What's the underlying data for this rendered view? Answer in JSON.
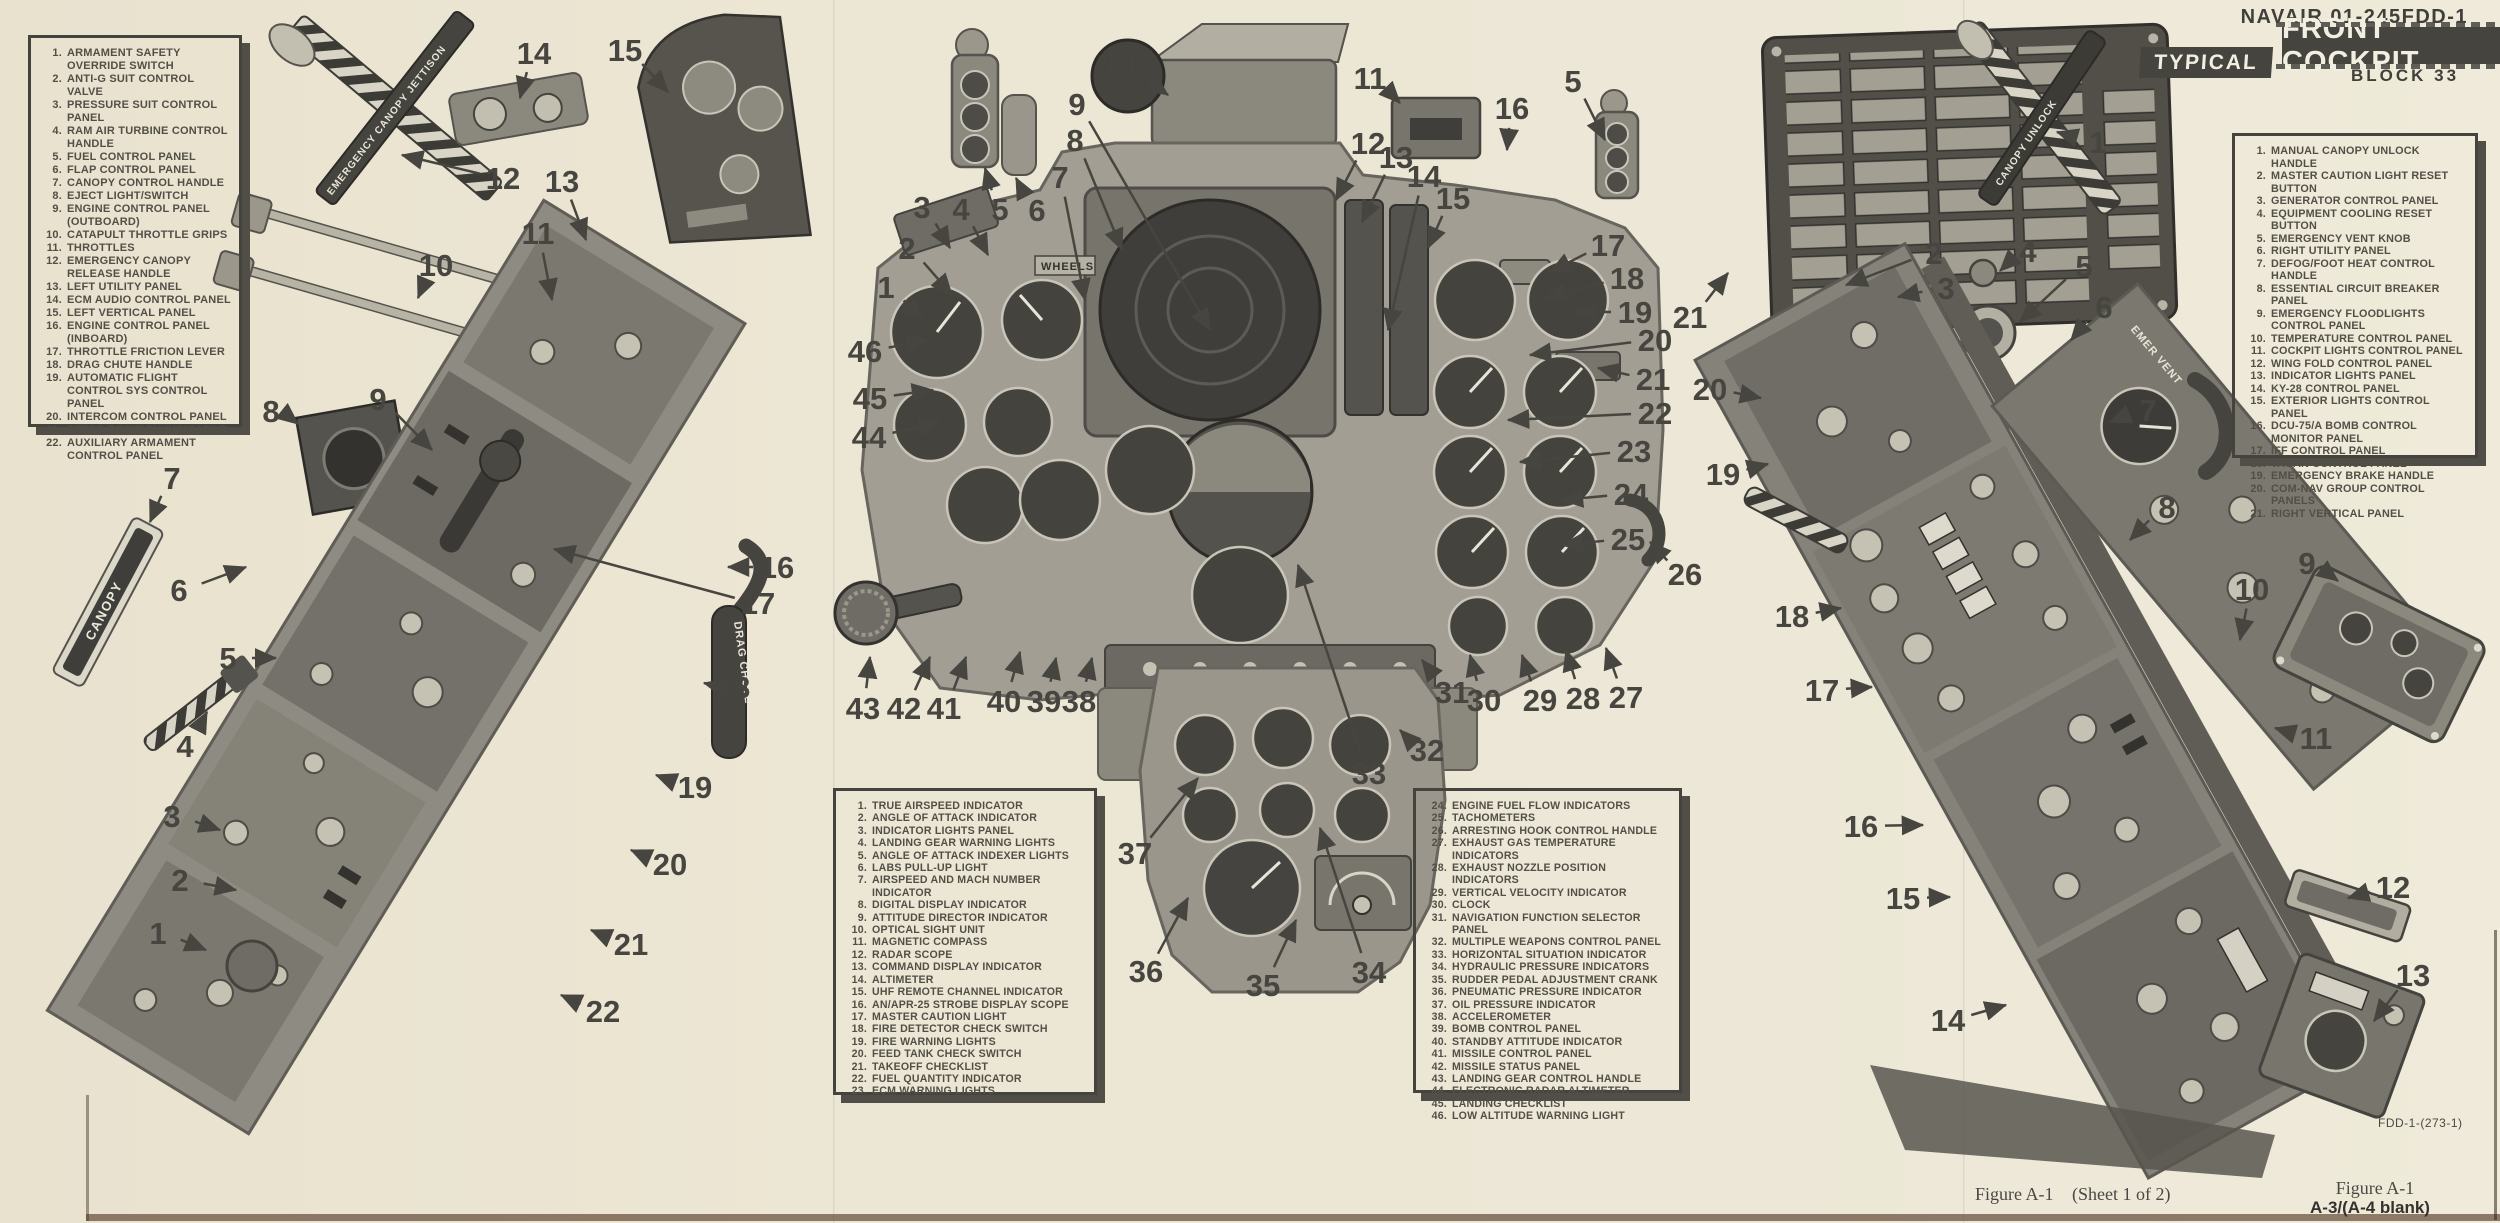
{
  "page": {
    "doc_number": "NAVAIR 01-245FDD-1",
    "title": "FRONT COCKPIT",
    "title_tag": "TYPICAL",
    "subtitle": "BLOCK 33",
    "caption_figure": "Figure A-1",
    "caption_sheet": "(Sheet 1 of 2)",
    "figure_ref": "Figure A-1",
    "page_number": "A-3/(A-4 blank)",
    "plate_code": "FDD-1-(273-1)"
  },
  "labels": {
    "canopy": "CANOPY",
    "drag_chute": "DRAG CHUTE",
    "jettison": "EMERGENCY CANOPY JETTISON",
    "unlock": "CANOPY UNLOCK",
    "emer_vent": "EMER VENT",
    "wheels": "WHEELS",
    "fire_l": "FIRE",
    "fire_r": "FIRE"
  },
  "legends": {
    "left_console": {
      "items": [
        {
          "n": "1.",
          "t": "ARMAMENT SAFETY OVERRIDE SWITCH"
        },
        {
          "n": "2.",
          "t": "ANTI-G SUIT CONTROL VALVE"
        },
        {
          "n": "3.",
          "t": "PRESSURE SUIT CONTROL PANEL"
        },
        {
          "n": "4.",
          "t": "RAM AIR TURBINE CONTROL HANDLE"
        },
        {
          "n": "5.",
          "t": "FUEL CONTROL PANEL"
        },
        {
          "n": "6.",
          "t": "FLAP CONTROL PANEL"
        },
        {
          "n": "7.",
          "t": "CANOPY CONTROL HANDLE"
        },
        {
          "n": "8.",
          "t": "EJECT LIGHT/SWITCH"
        },
        {
          "n": "9.",
          "t": "ENGINE CONTROL PANEL (OUTBOARD)"
        },
        {
          "n": "10.",
          "t": "CATAPULT THROTTLE GRIPS"
        },
        {
          "n": "11.",
          "t": "THROTTLES"
        },
        {
          "n": "12.",
          "t": "EMERGENCY CANOPY RELEASE HANDLE"
        },
        {
          "n": "13.",
          "t": "LEFT UTILITY PANEL"
        },
        {
          "n": "14.",
          "t": "ECM AUDIO CONTROL PANEL"
        },
        {
          "n": "15.",
          "t": "LEFT VERTICAL PANEL"
        },
        {
          "n": "16.",
          "t": "ENGINE CONTROL PANEL (INBOARD)"
        },
        {
          "n": "17.",
          "t": "THROTTLE FRICTION LEVER"
        },
        {
          "n": "18.",
          "t": "DRAG CHUTE HANDLE"
        },
        {
          "n": "19.",
          "t": "AUTOMATIC FLIGHT CONTROL SYS CONTROL PANEL"
        },
        {
          "n": "20.",
          "t": "INTERCOM CONTROL PANEL"
        },
        {
          "n": "21.",
          "t": "STEPS POSITION INDICATOR"
        },
        {
          "n": "22.",
          "t": "AUXILIARY ARMAMENT CONTROL PANEL"
        }
      ]
    },
    "main_panel_a": {
      "items": [
        {
          "n": "1.",
          "t": "TRUE AIRSPEED INDICATOR"
        },
        {
          "n": "2.",
          "t": "ANGLE OF ATTACK INDICATOR"
        },
        {
          "n": "3.",
          "t": "INDICATOR LIGHTS PANEL"
        },
        {
          "n": "4.",
          "t": "LANDING GEAR WARNING LIGHTS"
        },
        {
          "n": "5.",
          "t": "ANGLE OF ATTACK INDEXER LIGHTS"
        },
        {
          "n": "6.",
          "t": "LABS PULL-UP LIGHT"
        },
        {
          "n": "7.",
          "t": "AIRSPEED AND MACH NUMBER INDICATOR"
        },
        {
          "n": "8.",
          "t": "DIGITAL DISPLAY INDICATOR"
        },
        {
          "n": "9.",
          "t": "ATTITUDE DIRECTOR INDICATOR"
        },
        {
          "n": "10.",
          "t": "OPTICAL SIGHT UNIT"
        },
        {
          "n": "11.",
          "t": "MAGNETIC COMPASS"
        },
        {
          "n": "12.",
          "t": "RADAR SCOPE"
        },
        {
          "n": "13.",
          "t": "COMMAND DISPLAY INDICATOR"
        },
        {
          "n": "14.",
          "t": "ALTIMETER"
        },
        {
          "n": "15.",
          "t": "UHF REMOTE CHANNEL INDICATOR"
        },
        {
          "n": "16.",
          "t": "AN/APR-25 STROBE DISPLAY SCOPE"
        },
        {
          "n": "17.",
          "t": "MASTER CAUTION LIGHT"
        },
        {
          "n": "18.",
          "t": "FIRE DETECTOR CHECK SWITCH"
        },
        {
          "n": "19.",
          "t": "FIRE WARNING LIGHTS"
        },
        {
          "n": "20.",
          "t": "FEED TANK CHECK SWITCH"
        },
        {
          "n": "21.",
          "t": "TAKEOFF CHECKLIST"
        },
        {
          "n": "22.",
          "t": "FUEL QUANTITY INDICATOR"
        },
        {
          "n": "23.",
          "t": "ECM WARNING LIGHTS"
        }
      ]
    },
    "main_panel_b": {
      "items": [
        {
          "n": "24.",
          "t": "ENGINE FUEL FLOW INDICATORS"
        },
        {
          "n": "25.",
          "t": "TACHOMETERS"
        },
        {
          "n": "26.",
          "t": "ARRESTING HOOK CONTROL HANDLE"
        },
        {
          "n": "27.",
          "t": "EXHAUST GAS TEMPERATURE INDICATORS"
        },
        {
          "n": "28.",
          "t": "EXHAUST NOZZLE POSITION INDICATORS"
        },
        {
          "n": "29.",
          "t": "VERTICAL VELOCITY INDICATOR"
        },
        {
          "n": "30.",
          "t": "CLOCK"
        },
        {
          "n": "31.",
          "t": "NAVIGATION FUNCTION SELECTOR PANEL"
        },
        {
          "n": "32.",
          "t": "MULTIPLE WEAPONS CONTROL PANEL"
        },
        {
          "n": "33.",
          "t": "HORIZONTAL SITUATION INDICATOR"
        },
        {
          "n": "34.",
          "t": "HYDRAULIC PRESSURE INDICATORS"
        },
        {
          "n": "35.",
          "t": "RUDDER PEDAL ADJUSTMENT CRANK"
        },
        {
          "n": "36.",
          "t": "PNEUMATIC PRESSURE INDICATOR"
        },
        {
          "n": "37.",
          "t": "OIL PRESSURE INDICATOR"
        },
        {
          "n": "38.",
          "t": "ACCELEROMETER"
        },
        {
          "n": "39.",
          "t": "BOMB CONTROL PANEL"
        },
        {
          "n": "40.",
          "t": "STANDBY ATTITUDE INDICATOR"
        },
        {
          "n": "41.",
          "t": "MISSILE CONTROL PANEL"
        },
        {
          "n": "42.",
          "t": "MISSILE STATUS PANEL"
        },
        {
          "n": "43.",
          "t": "LANDING GEAR CONTROL HANDLE"
        },
        {
          "n": "44.",
          "t": "ELECTRONIC RADAR ALTIMETER"
        },
        {
          "n": "45.",
          "t": "LANDING CHECKLIST"
        },
        {
          "n": "46.",
          "t": "LOW ALTITUDE WARNING LIGHT"
        }
      ]
    },
    "right_console": {
      "items": [
        {
          "n": "1.",
          "t": "MANUAL CANOPY UNLOCK HANDLE"
        },
        {
          "n": "2.",
          "t": "MASTER CAUTION LIGHT RESET BUTTON"
        },
        {
          "n": "3.",
          "t": "GENERATOR CONTROL PANEL"
        },
        {
          "n": "4.",
          "t": "EQUIPMENT COOLING RESET BUTTON"
        },
        {
          "n": "5.",
          "t": "EMERGENCY VENT KNOB"
        },
        {
          "n": "6.",
          "t": "RIGHT UTILITY PANEL"
        },
        {
          "n": "7.",
          "t": "DEFOG/FOOT HEAT CONTROL HANDLE"
        },
        {
          "n": "8.",
          "t": "ESSENTIAL CIRCUIT BREAKER PANEL"
        },
        {
          "n": "9.",
          "t": "EMERGENCY FLOODLIGHTS CONTROL PANEL"
        },
        {
          "n": "10.",
          "t": "TEMPERATURE CONTROL PANEL"
        },
        {
          "n": "11.",
          "t": "COCKPIT LIGHTS CONTROL PANEL"
        },
        {
          "n": "12.",
          "t": "WING FOLD CONTROL PANEL"
        },
        {
          "n": "13.",
          "t": "INDICATOR LIGHTS PANEL"
        },
        {
          "n": "14.",
          "t": "KY-28 CONTROL PANEL"
        },
        {
          "n": "15.",
          "t": "EXTERIOR LIGHTS CONTROL PANEL"
        },
        {
          "n": "16.",
          "t": "DCU-75/A BOMB CONTROL MONITOR PANEL"
        },
        {
          "n": "17.",
          "t": "IFF CONTROL PANEL"
        },
        {
          "n": "18.",
          "t": "TACAN CONTROL PANEL"
        },
        {
          "n": "19.",
          "t": "EMERGENCY BRAKE HANDLE"
        },
        {
          "n": "20.",
          "t": "COM-NAV GROUP CONTROL PANELS"
        },
        {
          "n": "21.",
          "t": "RIGHT VERTICAL PANEL"
        }
      ]
    }
  },
  "callouts": {
    "left": [
      {
        "n": "14",
        "x": 534,
        "y": 53,
        "tx": 520,
        "ty": 98
      },
      {
        "n": "15",
        "x": 625,
        "y": 50,
        "tx": 668,
        "ty": 92
      },
      {
        "n": "12",
        "x": 503,
        "y": 178,
        "tx": 402,
        "ty": 155
      },
      {
        "n": "13",
        "x": 562,
        "y": 181,
        "tx": 586,
        "ty": 240
      },
      {
        "n": "11",
        "x": 538,
        "y": 233,
        "tx": 552,
        "ty": 300
      },
      {
        "n": "10",
        "x": 436,
        "y": 265,
        "tx": 418,
        "ty": 298
      },
      {
        "n": "9",
        "x": 378,
        "y": 399,
        "tx": 432,
        "ty": 450
      },
      {
        "n": "8",
        "x": 271,
        "y": 411,
        "tx": 298,
        "ty": 424
      },
      {
        "n": "7",
        "x": 172,
        "y": 478,
        "tx": 150,
        "ty": 522
      },
      {
        "n": "6",
        "x": 179,
        "y": 590,
        "tx": 246,
        "ty": 567
      },
      {
        "n": "5",
        "x": 228,
        "y": 658,
        "tx": 276,
        "ty": 658
      },
      {
        "n": "4",
        "x": 185,
        "y": 746,
        "tx": 207,
        "ty": 712
      },
      {
        "n": "3",
        "x": 172,
        "y": 816,
        "tx": 220,
        "ty": 830
      },
      {
        "n": "2",
        "x": 180,
        "y": 880,
        "tx": 236,
        "ty": 890
      },
      {
        "n": "1",
        "x": 158,
        "y": 933,
        "tx": 206,
        "ty": 950
      },
      {
        "n": "16",
        "x": 777,
        "y": 567,
        "tx": 728,
        "ty": 567
      },
      {
        "n": "17",
        "x": 758,
        "y": 603,
        "tx": 554,
        "ty": 549
      },
      {
        "n": "18",
        "x": 733,
        "y": 687,
        "tx": 704,
        "ty": 683
      },
      {
        "n": "19",
        "x": 695,
        "y": 787,
        "tx": 656,
        "ty": 775
      },
      {
        "n": "20",
        "x": 670,
        "y": 864,
        "tx": 631,
        "ty": 850
      },
      {
        "n": "21",
        "x": 631,
        "y": 944,
        "tx": 591,
        "ty": 930
      },
      {
        "n": "22",
        "x": 603,
        "y": 1011,
        "tx": 561,
        "ty": 995
      }
    ],
    "center": [
      {
        "n": "10",
        "x": 1119,
        "y": 63,
        "tx": 1168,
        "ty": 95
      },
      {
        "n": "9",
        "x": 1077,
        "y": 104,
        "tx": 1210,
        "ty": 330
      },
      {
        "n": "8",
        "x": 1075,
        "y": 140,
        "tx": 1122,
        "ty": 250
      },
      {
        "n": "7",
        "x": 1060,
        "y": 177,
        "tx": 1085,
        "ty": 300
      },
      {
        "n": "3",
        "x": 922,
        "y": 207,
        "tx": 950,
        "ty": 248
      },
      {
        "n": "4",
        "x": 961,
        "y": 209,
        "tx": 988,
        "ty": 255
      },
      {
        "n": "5",
        "x": 1000,
        "y": 209,
        "tx": 985,
        "ty": 168
      },
      {
        "n": "6",
        "x": 1037,
        "y": 210,
        "tx": 1016,
        "ty": 178
      },
      {
        "n": "2",
        "x": 907,
        "y": 248,
        "tx": 952,
        "ty": 295
      },
      {
        "n": "1",
        "x": 886,
        "y": 287,
        "tx": 922,
        "ty": 320
      },
      {
        "n": "46",
        "x": 865,
        "y": 351,
        "tx": 928,
        "ty": 340
      },
      {
        "n": "45",
        "x": 870,
        "y": 398,
        "tx": 933,
        "ty": 390
      },
      {
        "n": "44",
        "x": 869,
        "y": 437,
        "tx": 940,
        "ty": 422
      },
      {
        "n": "11",
        "x": 1370,
        "y": 78,
        "tx": 1400,
        "ty": 103
      },
      {
        "n": "5",
        "x": 1573,
        "y": 81,
        "tx": 1605,
        "ty": 140
      },
      {
        "n": "16",
        "x": 1512,
        "y": 108,
        "tx": 1507,
        "ty": 150
      },
      {
        "n": "12",
        "x": 1368,
        "y": 143,
        "tx": 1336,
        "ty": 200
      },
      {
        "n": "13",
        "x": 1396,
        "y": 157,
        "tx": 1362,
        "ty": 222
      },
      {
        "n": "14",
        "x": 1424,
        "y": 176,
        "tx": 1388,
        "ty": 330
      },
      {
        "n": "15",
        "x": 1453,
        "y": 198,
        "tx": 1428,
        "ty": 248
      },
      {
        "n": "17",
        "x": 1608,
        "y": 245,
        "tx": 1550,
        "ty": 272
      },
      {
        "n": "18",
        "x": 1627,
        "y": 278,
        "tx": 1545,
        "ty": 298
      },
      {
        "n": "19",
        "x": 1635,
        "y": 312,
        "tx": 1576,
        "ty": 312
      },
      {
        "n": "20",
        "x": 1655,
        "y": 340,
        "tx": 1530,
        "ty": 355
      },
      {
        "n": "21",
        "x": 1653,
        "y": 379,
        "tx": 1598,
        "ty": 368
      },
      {
        "n": "22",
        "x": 1655,
        "y": 413,
        "tx": 1508,
        "ty": 420
      },
      {
        "n": "23",
        "x": 1634,
        "y": 451,
        "tx": 1520,
        "ty": 462
      },
      {
        "n": "24",
        "x": 1631,
        "y": 494,
        "tx": 1562,
        "ty": 500
      },
      {
        "n": "25",
        "x": 1628,
        "y": 539,
        "tx": 1562,
        "ty": 545
      },
      {
        "n": "26",
        "x": 1685,
        "y": 574,
        "tx": 1650,
        "ty": 542
      },
      {
        "n": "27",
        "x": 1626,
        "y": 697,
        "tx": 1606,
        "ty": 648
      },
      {
        "n": "28",
        "x": 1583,
        "y": 698,
        "tx": 1566,
        "ty": 650
      },
      {
        "n": "29",
        "x": 1540,
        "y": 700,
        "tx": 1522,
        "ty": 655
      },
      {
        "n": "30",
        "x": 1484,
        "y": 700,
        "tx": 1470,
        "ty": 655
      },
      {
        "n": "31",
        "x": 1452,
        "y": 692,
        "tx": 1422,
        "ty": 660
      },
      {
        "n": "32",
        "x": 1427,
        "y": 750,
        "tx": 1400,
        "ty": 730
      },
      {
        "n": "33",
        "x": 1369,
        "y": 773,
        "tx": 1298,
        "ty": 565
      },
      {
        "n": "34",
        "x": 1369,
        "y": 972,
        "tx": 1320,
        "ty": 828
      },
      {
        "n": "35",
        "x": 1263,
        "y": 985,
        "tx": 1296,
        "ty": 920
      },
      {
        "n": "36",
        "x": 1146,
        "y": 971,
        "tx": 1188,
        "ty": 898
      },
      {
        "n": "37",
        "x": 1135,
        "y": 853,
        "tx": 1198,
        "ty": 778
      },
      {
        "n": "38",
        "x": 1079,
        "y": 701,
        "tx": 1092,
        "ty": 658
      },
      {
        "n": "39",
        "x": 1044,
        "y": 701,
        "tx": 1056,
        "ty": 658
      },
      {
        "n": "40",
        "x": 1004,
        "y": 701,
        "tx": 1020,
        "ty": 652
      },
      {
        "n": "41",
        "x": 944,
        "y": 708,
        "tx": 966,
        "ty": 657
      },
      {
        "n": "42",
        "x": 904,
        "y": 708,
        "tx": 930,
        "ty": 657
      },
      {
        "n": "43",
        "x": 863,
        "y": 708,
        "tx": 870,
        "ty": 657
      }
    ],
    "right": [
      {
        "n": "1",
        "x": 2098,
        "y": 142,
        "tx": 2057,
        "ty": 132
      },
      {
        "n": "2",
        "x": 1934,
        "y": 253,
        "tx": 1846,
        "ty": 285
      },
      {
        "n": "3",
        "x": 1946,
        "y": 288,
        "tx": 1898,
        "ty": 297
      },
      {
        "n": "4",
        "x": 2028,
        "y": 251,
        "tx": 2000,
        "ty": 271
      },
      {
        "n": "5",
        "x": 2084,
        "y": 266,
        "tx": 2020,
        "ty": 322
      },
      {
        "n": "6",
        "x": 2104,
        "y": 307,
        "tx": 2071,
        "ty": 340
      },
      {
        "n": "7",
        "x": 2148,
        "y": 410,
        "tx": 2110,
        "ty": 422
      },
      {
        "n": "8",
        "x": 2167,
        "y": 507,
        "tx": 2130,
        "ty": 540
      },
      {
        "n": "9",
        "x": 2307,
        "y": 563,
        "tx": 2338,
        "ty": 581
      },
      {
        "n": "10",
        "x": 2252,
        "y": 589,
        "tx": 2240,
        "ty": 640
      },
      {
        "n": "11",
        "x": 2316,
        "y": 738,
        "tx": 2275,
        "ty": 728
      },
      {
        "n": "12",
        "x": 2393,
        "y": 887,
        "tx": 2348,
        "ty": 898
      },
      {
        "n": "13",
        "x": 2413,
        "y": 975,
        "tx": 2374,
        "ty": 1021
      },
      {
        "n": "14",
        "x": 1948,
        "y": 1020,
        "tx": 2006,
        "ty": 1005
      },
      {
        "n": "15",
        "x": 1903,
        "y": 898,
        "tx": 1950,
        "ty": 897
      },
      {
        "n": "16",
        "x": 1861,
        "y": 826,
        "tx": 1923,
        "ty": 825
      },
      {
        "n": "17",
        "x": 1822,
        "y": 690,
        "tx": 1872,
        "ty": 687
      },
      {
        "n": "18",
        "x": 1792,
        "y": 616,
        "tx": 1841,
        "ty": 608
      },
      {
        "n": "19",
        "x": 1723,
        "y": 474,
        "tx": 1768,
        "ty": 464
      },
      {
        "n": "20",
        "x": 1710,
        "y": 389,
        "tx": 1761,
        "ty": 398
      },
      {
        "n": "21",
        "x": 1690,
        "y": 317,
        "tx": 1728,
        "ty": 273
      }
    ]
  }
}
